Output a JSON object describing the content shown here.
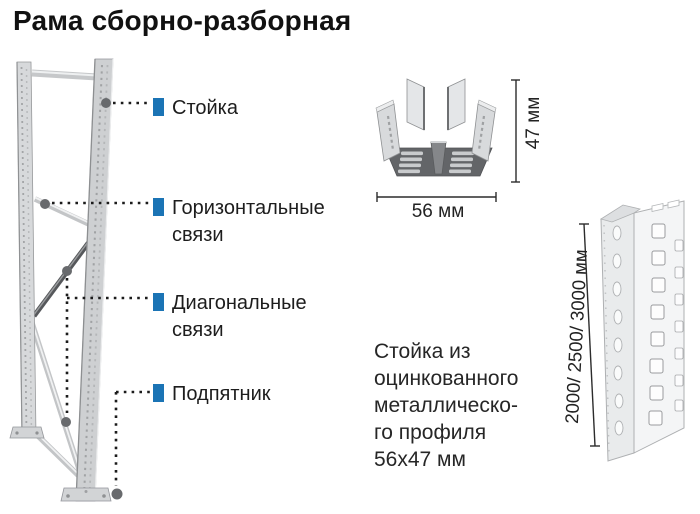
{
  "title": "Рама сборно-разборная",
  "colors": {
    "accent_blue": "#1b74b5",
    "marker_gray": "#686a6d"
  },
  "callouts": [
    {
      "label": "Стойка"
    },
    {
      "label": "Горизонтальные связи"
    },
    {
      "label": "Диагональные связи"
    },
    {
      "label": "Подпятник"
    }
  ],
  "cross_section": {
    "height_label": "47 мм",
    "width_label": "56 мм"
  },
  "upright_profile": {
    "length_label": "2000/ 2500/ 3000 мм"
  },
  "description": "Стойка из\nоцинкованного\nметаллическо-\nго профиля\n56х47 мм"
}
